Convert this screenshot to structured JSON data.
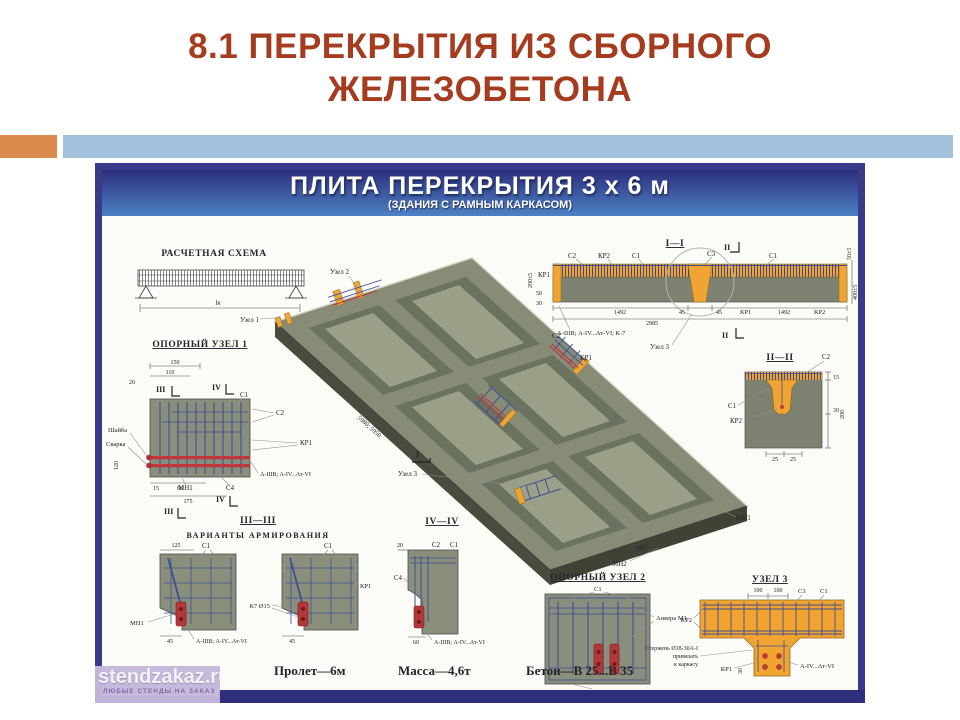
{
  "colors": {
    "title_text": "#a63c1f",
    "accent_orange": "#dd8a4e",
    "accent_blue": "#a3c1dc",
    "poster_border": "#3a3a8c",
    "header_top": "#2c2f7d",
    "header_bottom": "#4d82c4",
    "slab_top": "#878c77",
    "slab_panel": "#9aa088",
    "concrete_orange": "#f0a433",
    "rebar_blue": "#3d4f94",
    "rebar_red": "#c2383c",
    "watermark_bg": "#c4b8db",
    "footer_band": "#2f2e7b"
  },
  "slide": {
    "title_line1": "8.1 ПЕРЕКРЫТИЯ ИЗ СБОРНОГО",
    "title_line2": "ЖЕЛЕЗОБЕТОНА"
  },
  "watermark": {
    "site": "stendzakaz.ru",
    "tagline": "ЛЮБЫЕ СТЕНДЫ НА ЗАКАЗ"
  },
  "poster": {
    "title": "ПЛИТА ПЕРЕКРЫТИЯ 3 х 6 м",
    "subtitle": "(ЗДАНИЯ С РАМНЫМ КАРКАСОМ)",
    "info": {
      "span": "Пролет—6м",
      "mass": "Масса—4,6т",
      "concrete": "Бетон—В 25...В 35"
    },
    "scheme": {
      "title": "РАСЧЕТНАЯ СХЕМА",
      "span": "lк"
    },
    "slab": {
      "node1": "Узел 1",
      "node2": "Узел 2",
      "node3": "Узел 3",
      "c2": "С2",
      "kr1": "КР1",
      "mn1": "МН1",
      "mn2": "МН2",
      "dim_length": "5980; 5950",
      "dim_width": "2985",
      "mark1": "I"
    },
    "node1": {
      "title": "ОПОРНЫЙ УЗЕЛ 1",
      "washer": "Шайба",
      "weld": "Сварка",
      "c1": "С1",
      "c2": "С2",
      "kr1": "КР1",
      "steel": "А-IIIВ; А-IV...Ат-VI",
      "c4": "С4",
      "mn1": "МН1",
      "d150": "150",
      "d110": "110",
      "d20": "20",
      "d120": "120",
      "d15": "15",
      "d60": "60",
      "d175": "175",
      "m3a": "III",
      "m4a": "IV",
      "m4b": "IV",
      "m3b": "III"
    },
    "sec33": {
      "title": "III—III",
      "subtitle": "ВАРИАНТЫ АРМИРОВАНИЯ",
      "d125": "125",
      "c1a": "С1",
      "mn1": "МН1",
      "d45a": "45",
      "steel": "А-IIIВ; А-IV...Ат-VI",
      "c1b": "С1",
      "kr1": "КР1",
      "k7": "К7 Ø15",
      "d45b": "45"
    },
    "sec44": {
      "title": "IV—IV",
      "d20": "20",
      "c2": "С2",
      "c1": "С1",
      "c4": "С4",
      "d60": "60",
      "steel": "А-IIIВ; А-IV...Ат-VI"
    },
    "node2": {
      "title": "ОПОРНЫЙ УЗЕЛ 2",
      "c1": "С1",
      "anchor": "Анкера М1",
      "mn2": "МН2"
    },
    "node3": {
      "title": "УЗЕЛ 3",
      "d100a": "100",
      "d100b": "100",
      "c3": "С3",
      "c1": "С1",
      "kr2": "КР2",
      "rod1": "Стержень Ø18-30А-I",
      "rod2": "привязать",
      "rod3": "к каркасу",
      "kr1": "КР1",
      "steel": "А-IV...Ат-VI",
      "d30": "30"
    },
    "sec11": {
      "title": "I—I",
      "c2": "С2",
      "kr2a": "КР2",
      "c1a": "С1",
      "c3": "С3",
      "m2a": "II",
      "c1b": "С1",
      "kr1a": "КР1",
      "d200": "200±5",
      "d50": "50",
      "d30": "30",
      "d50r": "50±5",
      "d400": "400±5",
      "d1492a": "1492",
      "d45a": "45",
      "d45b": "45",
      "kr1b": "КР1",
      "d1492b": "1492",
      "kr2b": "КР2",
      "d2985": "2985",
      "steel": "А-IIIВ; А-IV...Ат-VI; К-7",
      "node3_ref": "Узел 3",
      "m2b": "II"
    },
    "sec22": {
      "title": "II—II",
      "c2": "С2",
      "c1": "С1",
      "kr2": "КР2",
      "d15": "15",
      "d200": "200",
      "d30": "30",
      "d25a": "25",
      "d25b": "25"
    }
  }
}
